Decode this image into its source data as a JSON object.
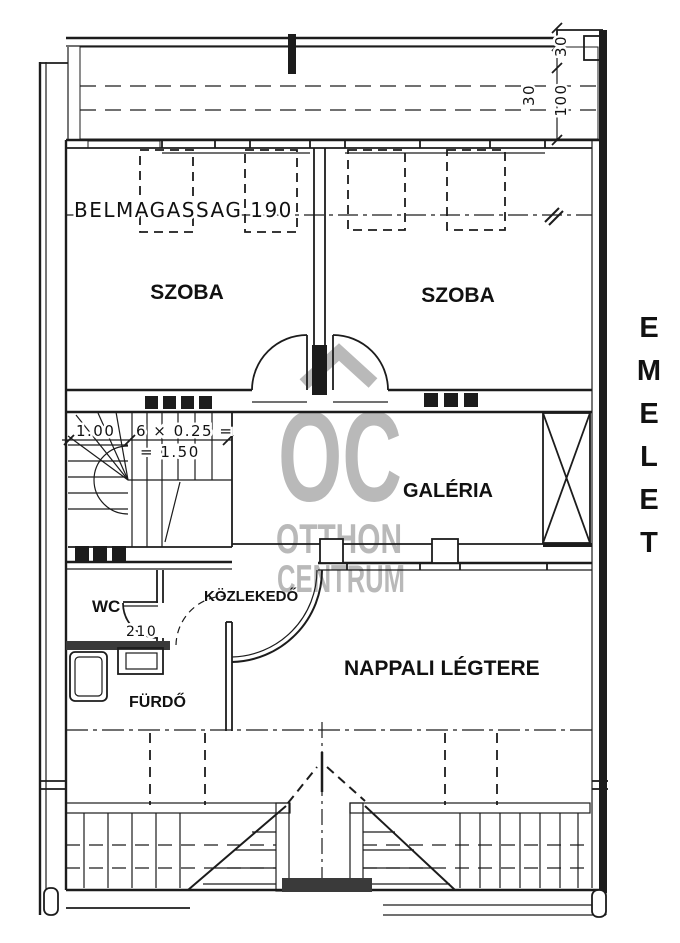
{
  "plan": {
    "side_label": {
      "word": "EMELET",
      "letters": [
        "E",
        "M",
        "E",
        "L",
        "E",
        "T"
      ]
    },
    "rooms": {
      "szoba_left": "SZOBA",
      "szoba_right": "SZOBA",
      "galeria": "GALÉRIA",
      "kozlekedo": "KÖZLEKEDŐ",
      "wc": "WC",
      "furdo": "FÜRDŐ",
      "nappali": "NAPPALI LÉGTERE"
    },
    "annotations": {
      "ceiling_height": "BELMAGASSAG 190",
      "stair_run_width": "1.00",
      "stair_formula": "6 × 0.25 =",
      "stair_result": "= 1.50",
      "door_height": "210",
      "dim_corner_30": "30",
      "dim_inner_30": "30",
      "dim_100": "100"
    },
    "watermark": {
      "logo": "OC",
      "line1": "OTTHON",
      "line2": "CENTRUM"
    },
    "colors": {
      "linework": "#1c1c1c",
      "dark_wall": "#3a3a3a",
      "watermark_gray": "#b9b9b9",
      "background": "#ffffff"
    }
  }
}
